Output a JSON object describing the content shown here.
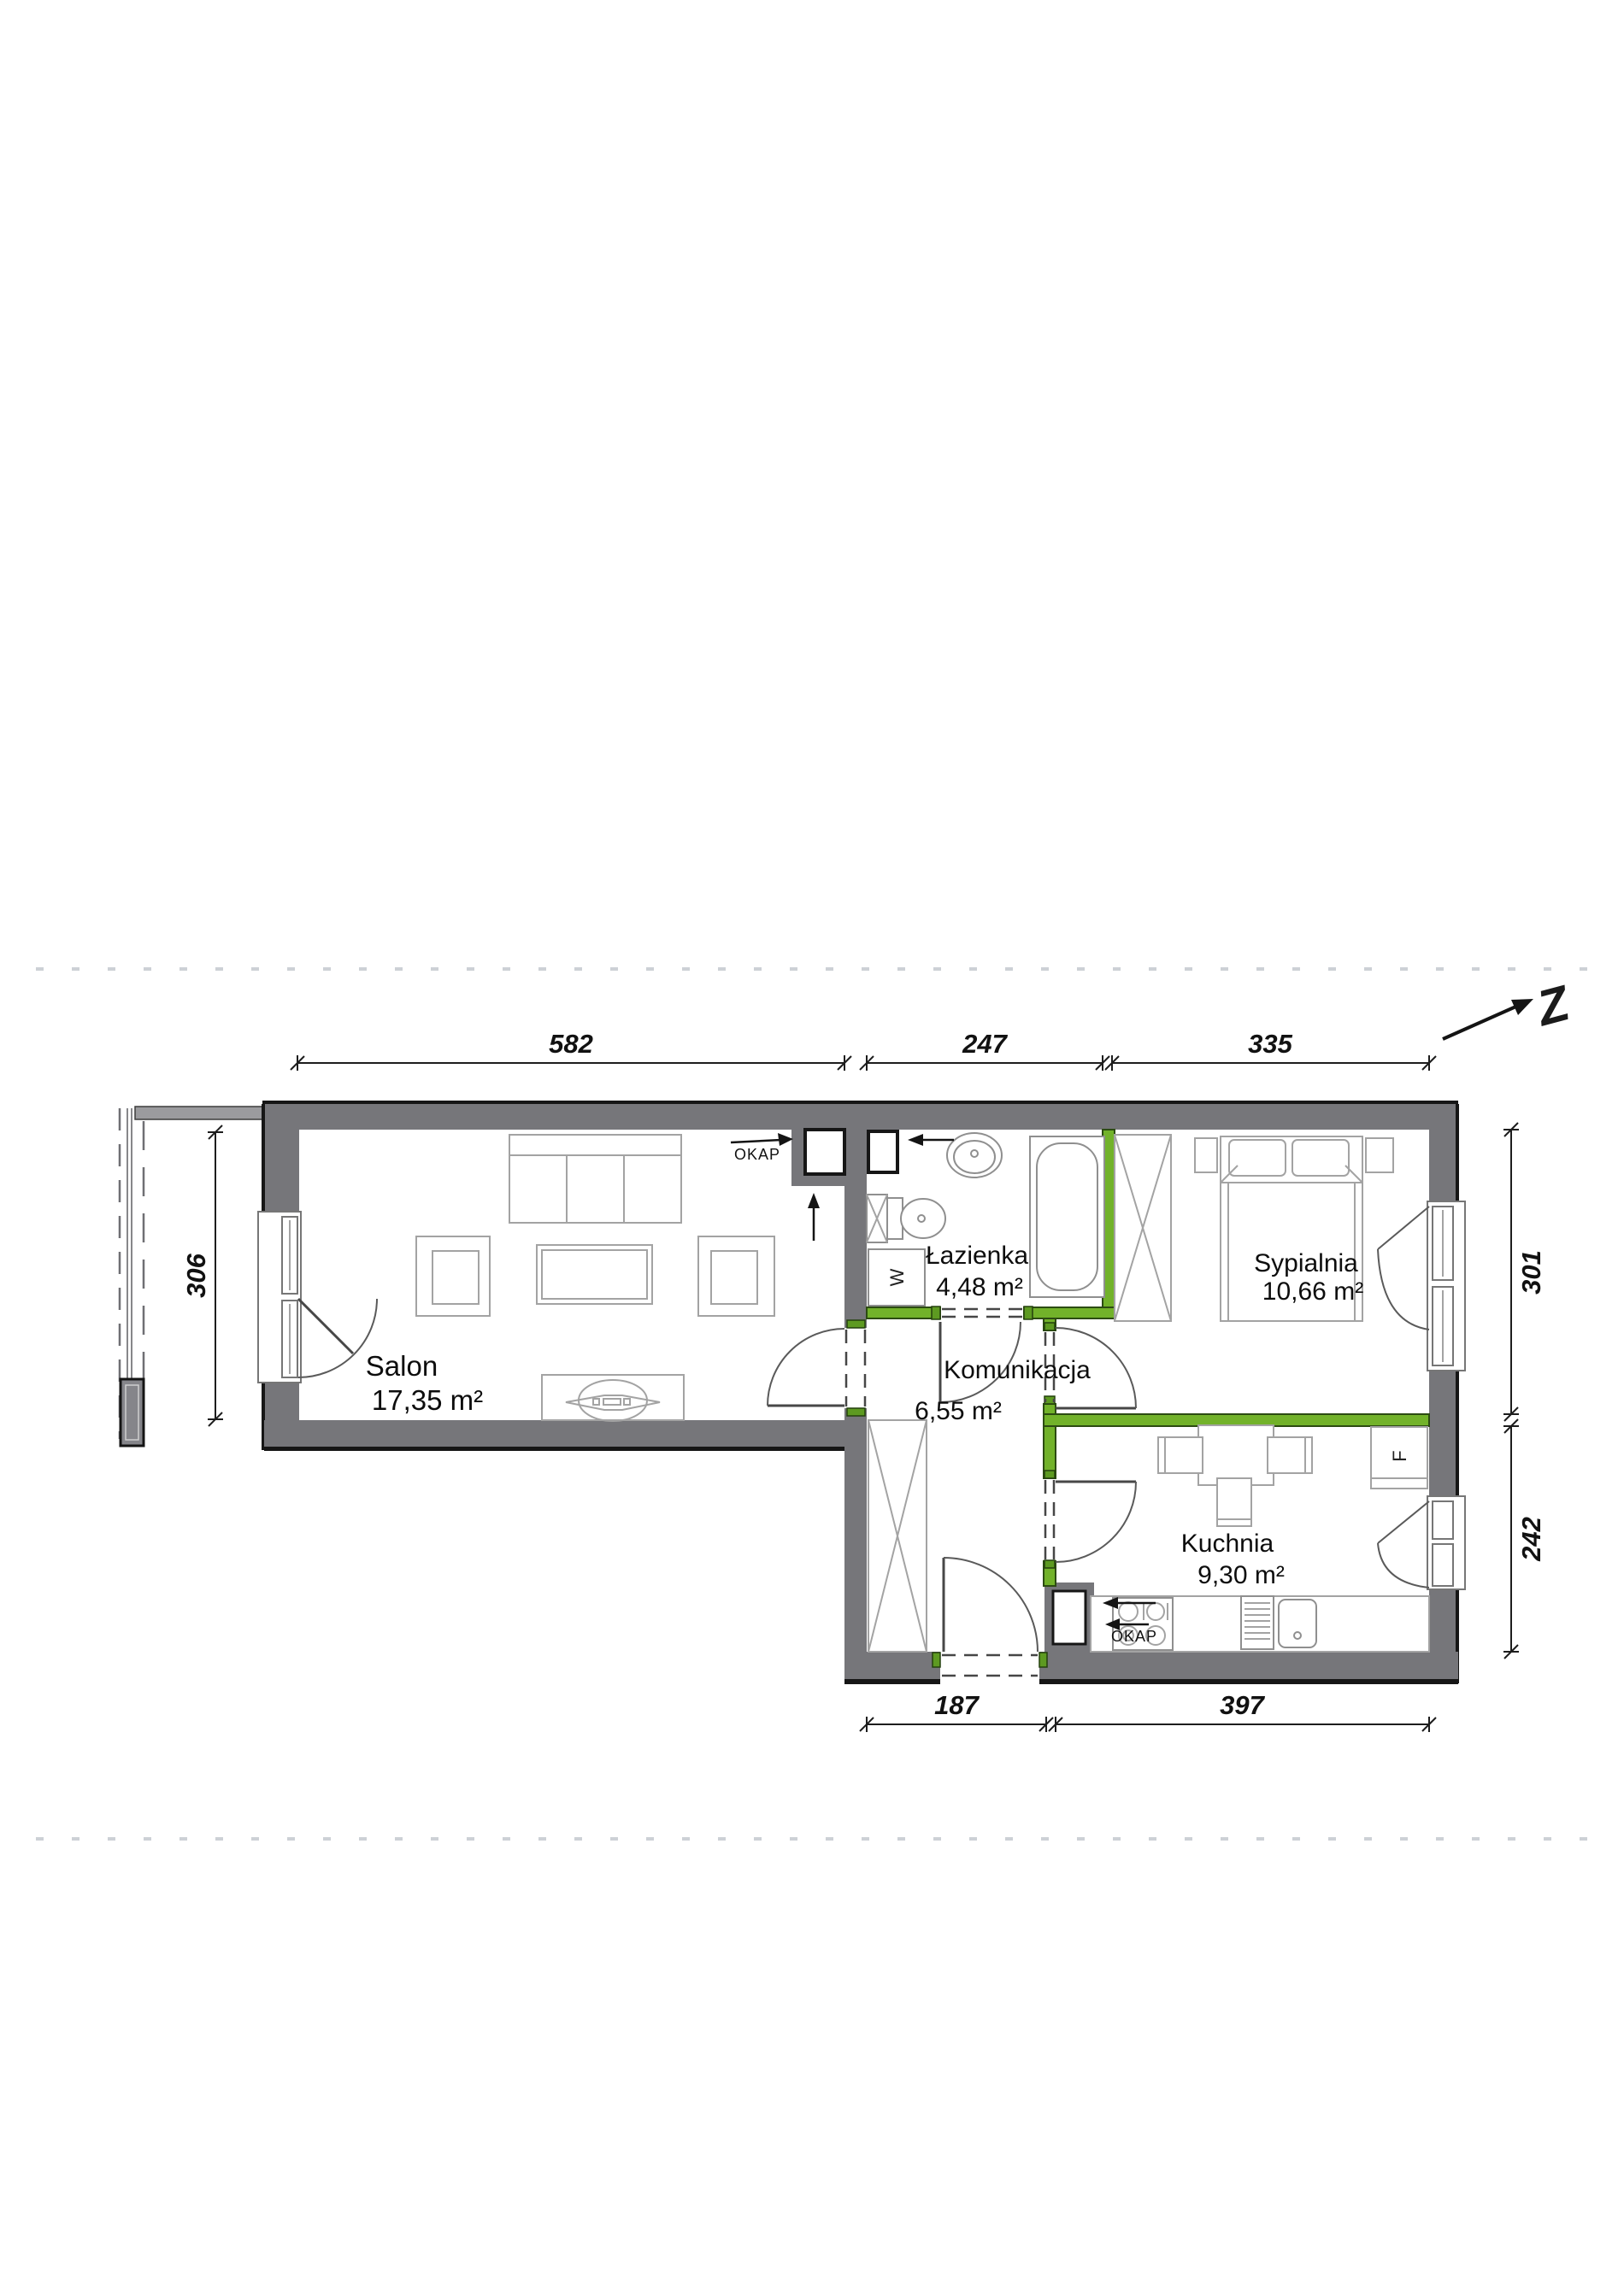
{
  "plan_type": "apartment-floor-plan",
  "compass": {
    "label": "Z"
  },
  "rooms": [
    {
      "name": "Salon",
      "area": "17,35 m²"
    },
    {
      "name": "Łazienka",
      "area": "4,48 m²"
    },
    {
      "name": "Komunikacja",
      "area": "6,55 m²"
    },
    {
      "name": "Sypialnia",
      "area": "10,66 m²"
    },
    {
      "name": "Kuchnia",
      "area": "9,30 m²"
    }
  ],
  "dimensions_cm": {
    "top": [
      "582",
      "247",
      "335"
    ],
    "bottom": [
      "187",
      "397"
    ],
    "left": [
      "306"
    ],
    "right": [
      "301",
      "242"
    ]
  },
  "equipment_labels": {
    "hood": "OKAP",
    "washing_machine": "W",
    "fridge": "F"
  },
  "colors": {
    "wall_gray": "#76767a",
    "partition_green": "#72b22a",
    "outline_black": "#161616",
    "furniture_line": "#a3a3a3",
    "faint_dash": "#cdd1d6",
    "background": "#ffffff"
  }
}
